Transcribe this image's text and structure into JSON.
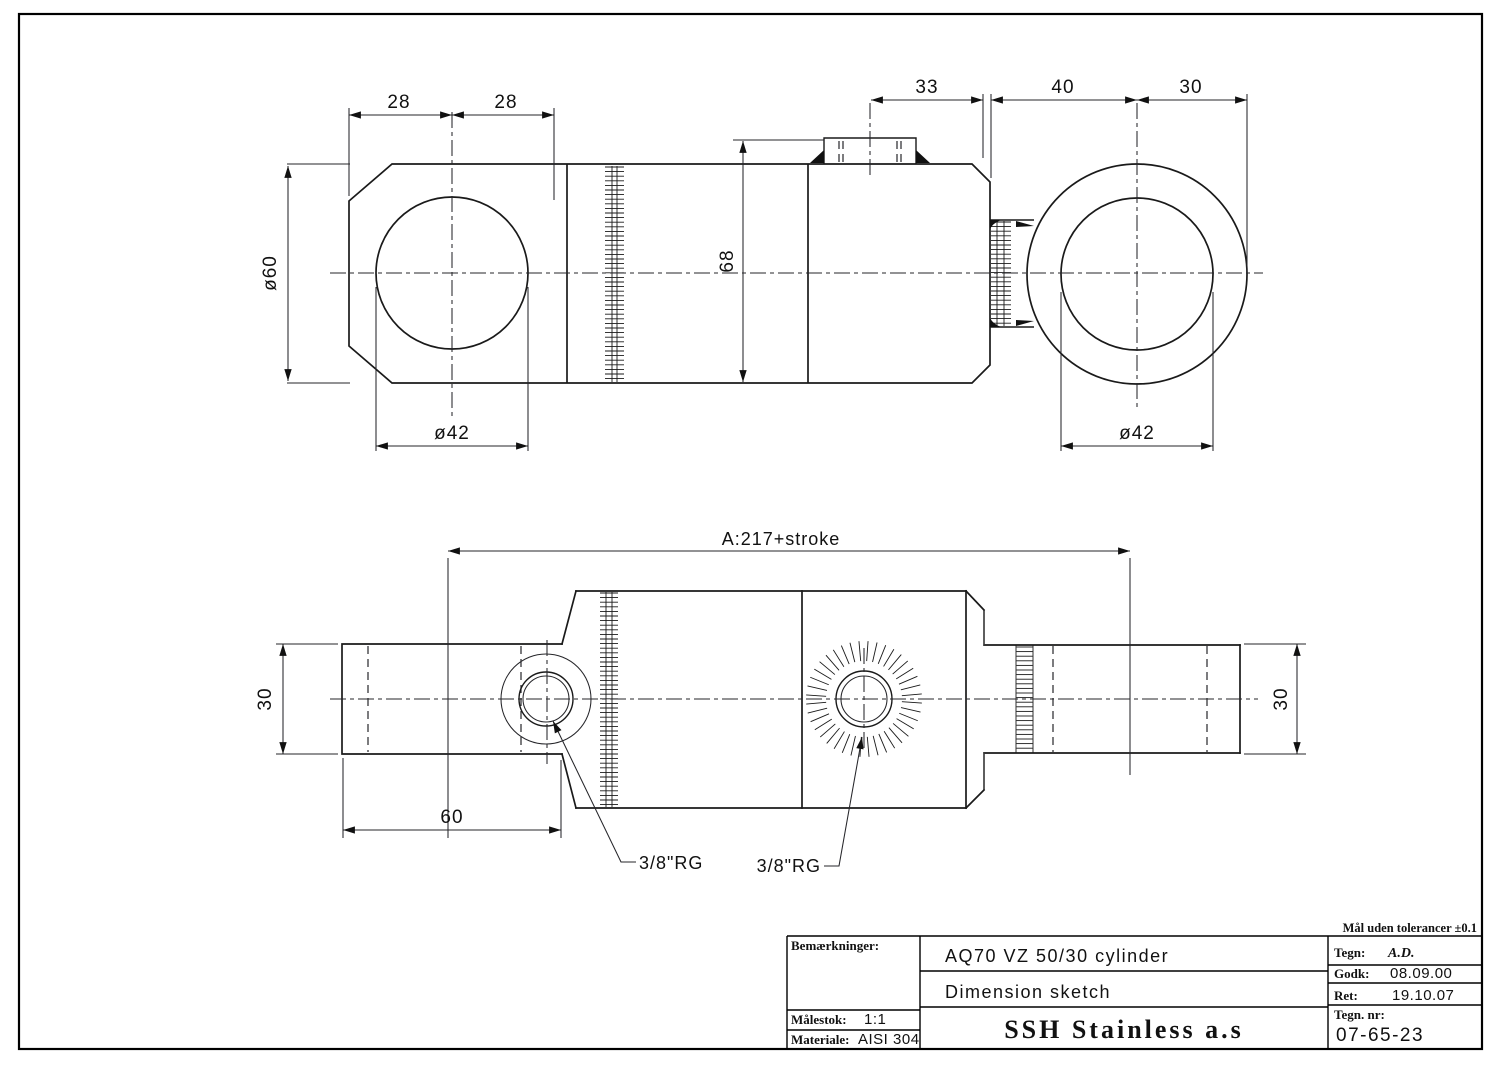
{
  "title_block": {
    "tolerance_note": "Mål uden tolerancer ±0.1",
    "remarks_label": "Bemærkninger:",
    "scale_label": "Målestok:",
    "scale_value": "1:1",
    "material_label": "Materiale:",
    "material_value": "AISI 304",
    "drawing_title": "AQ70 VZ 50/30 cylinder",
    "drawing_subtitle": "Dimension sketch",
    "company": "SSH Stainless a.s",
    "drawn_label": "Tegn:",
    "drawn_value": "A.D.",
    "approved_label": "Godk:",
    "approved_value": "08.09.00",
    "revision_label": "Ret:",
    "revision_value": "19.10.07",
    "drawing_number_label": "Tegn. nr:",
    "drawing_number_value": "07-65-23"
  },
  "top_view": {
    "dims": {
      "d28_left": "28",
      "d28_right": "28",
      "d33": "33",
      "d40": "40",
      "d30": "30",
      "d60": "ø60",
      "d68": "68",
      "d42_left": "ø42",
      "d42_right": "ø42"
    }
  },
  "bottom_view": {
    "dims": {
      "overall": "A:217+stroke",
      "rod_left": "30",
      "rod_right": "30",
      "clevis_len": "60"
    },
    "ports": {
      "port1": "3/8\"RG",
      "port2": "3/8\"RG"
    }
  }
}
